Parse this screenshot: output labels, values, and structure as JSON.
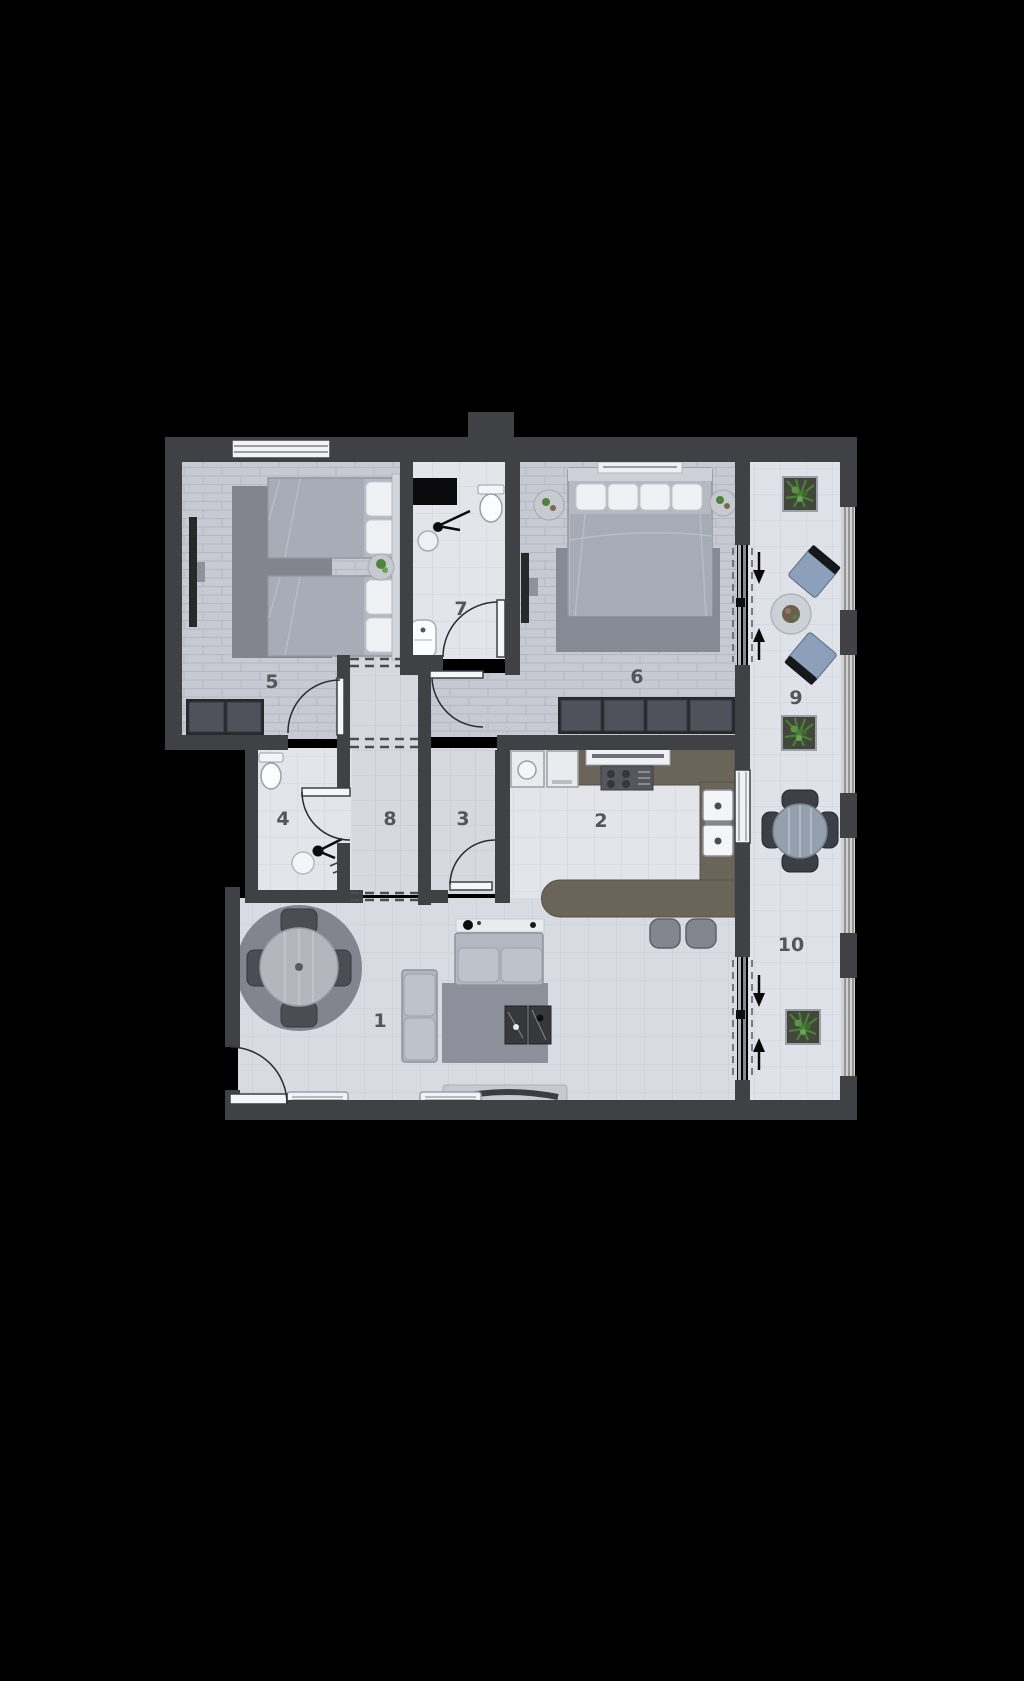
{
  "plan": {
    "type": "apartment-floor-plan",
    "rooms": [
      {
        "id": "living-room",
        "label": "1"
      },
      {
        "id": "kitchen",
        "label": "2"
      },
      {
        "id": "room-3",
        "label": "3"
      },
      {
        "id": "bathroom-4",
        "label": "4"
      },
      {
        "id": "bedroom-5",
        "label": "5"
      },
      {
        "id": "bedroom-6",
        "label": "6"
      },
      {
        "id": "bathroom-7",
        "label": "7"
      },
      {
        "id": "hallway-8",
        "label": "8"
      },
      {
        "id": "balcony-9",
        "label": "9"
      },
      {
        "id": "balcony-10",
        "label": "10"
      }
    ],
    "colors": {
      "background": "#000000",
      "wall": "#3f4145",
      "floor_tile": "#e3e5ea",
      "floor_plank": "#c7cad2",
      "floor_hall": "#d6d9e0",
      "floor_living": "#d8dbe2",
      "floor_balcony": "#dfe2e9",
      "counter": "#6b6459",
      "rug": "#84878f",
      "furniture": "#b5b9c2",
      "chair_blue": "#8ca0bc",
      "plant_green": "#4e8340",
      "label_text": "#54565b"
    }
  }
}
